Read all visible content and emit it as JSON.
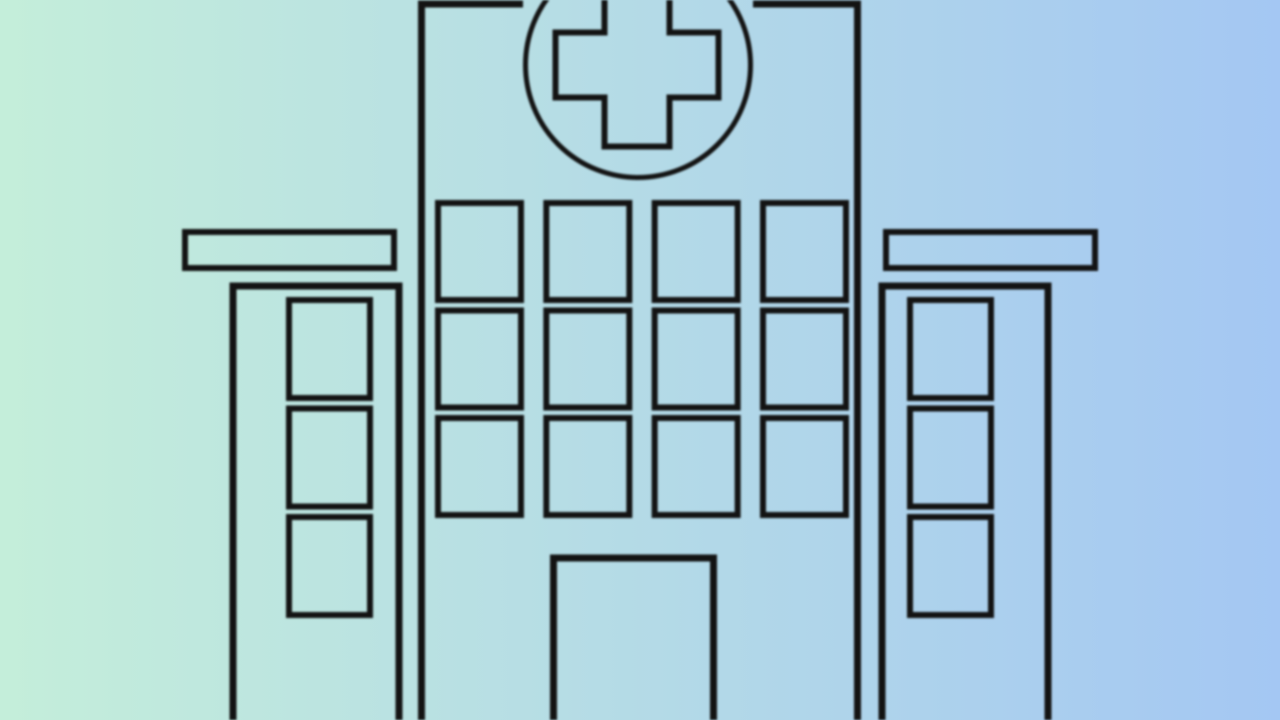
{
  "meta": {
    "description": "Flat black line-art illustration of a hospital building with a medical cross emblem on a pastel mint-to-blue gradient background",
    "canvas": {
      "width": 1280,
      "height": 720
    }
  },
  "colors": {
    "background_left": "#c4eeda",
    "background_right": "#a4c7f3",
    "line": "#131313"
  },
  "illustration": {
    "subject": "hospital-building",
    "emblem": "medical-cross-in-circle",
    "emblem_circle": {
      "cx": 638,
      "cy": 65,
      "r": 112.5
    },
    "main_tower": {
      "left": 421.5,
      "right": 857.5,
      "top": 4,
      "window_cols": 4,
      "window_rows": 3,
      "has_door": true
    },
    "door": {
      "left": 553.5,
      "right": 713.5,
      "top": 558
    },
    "left_wing": {
      "body_left": 233,
      "body_right": 399,
      "body_top": 286,
      "roof": {
        "x": 185,
        "y": 232,
        "w": 209,
        "h": 36
      },
      "window_rows": 3
    },
    "right_wing": {
      "body_left": 882,
      "body_right": 1048,
      "body_top": 286,
      "roof": {
        "x": 886,
        "y": 232,
        "w": 209,
        "h": 36
      },
      "window_rows": 3
    },
    "window_grids": [
      {
        "container": "main-tower-windows",
        "cols": 4,
        "rows": 3,
        "x": 438,
        "y": 203,
        "w": 83,
        "h": 97,
        "dx": 108.33,
        "dy": 107.5
      },
      {
        "container": "left-wing-windows",
        "cols": 1,
        "rows": 3,
        "x": 289,
        "y": 300,
        "w": 81,
        "h": 98,
        "dx": 0,
        "dy": 108.5
      },
      {
        "container": "right-wing-windows",
        "cols": 1,
        "rows": 3,
        "x": 910,
        "y": 300,
        "w": 81,
        "h": 98,
        "dx": 0,
        "dy": 108.5
      }
    ]
  }
}
